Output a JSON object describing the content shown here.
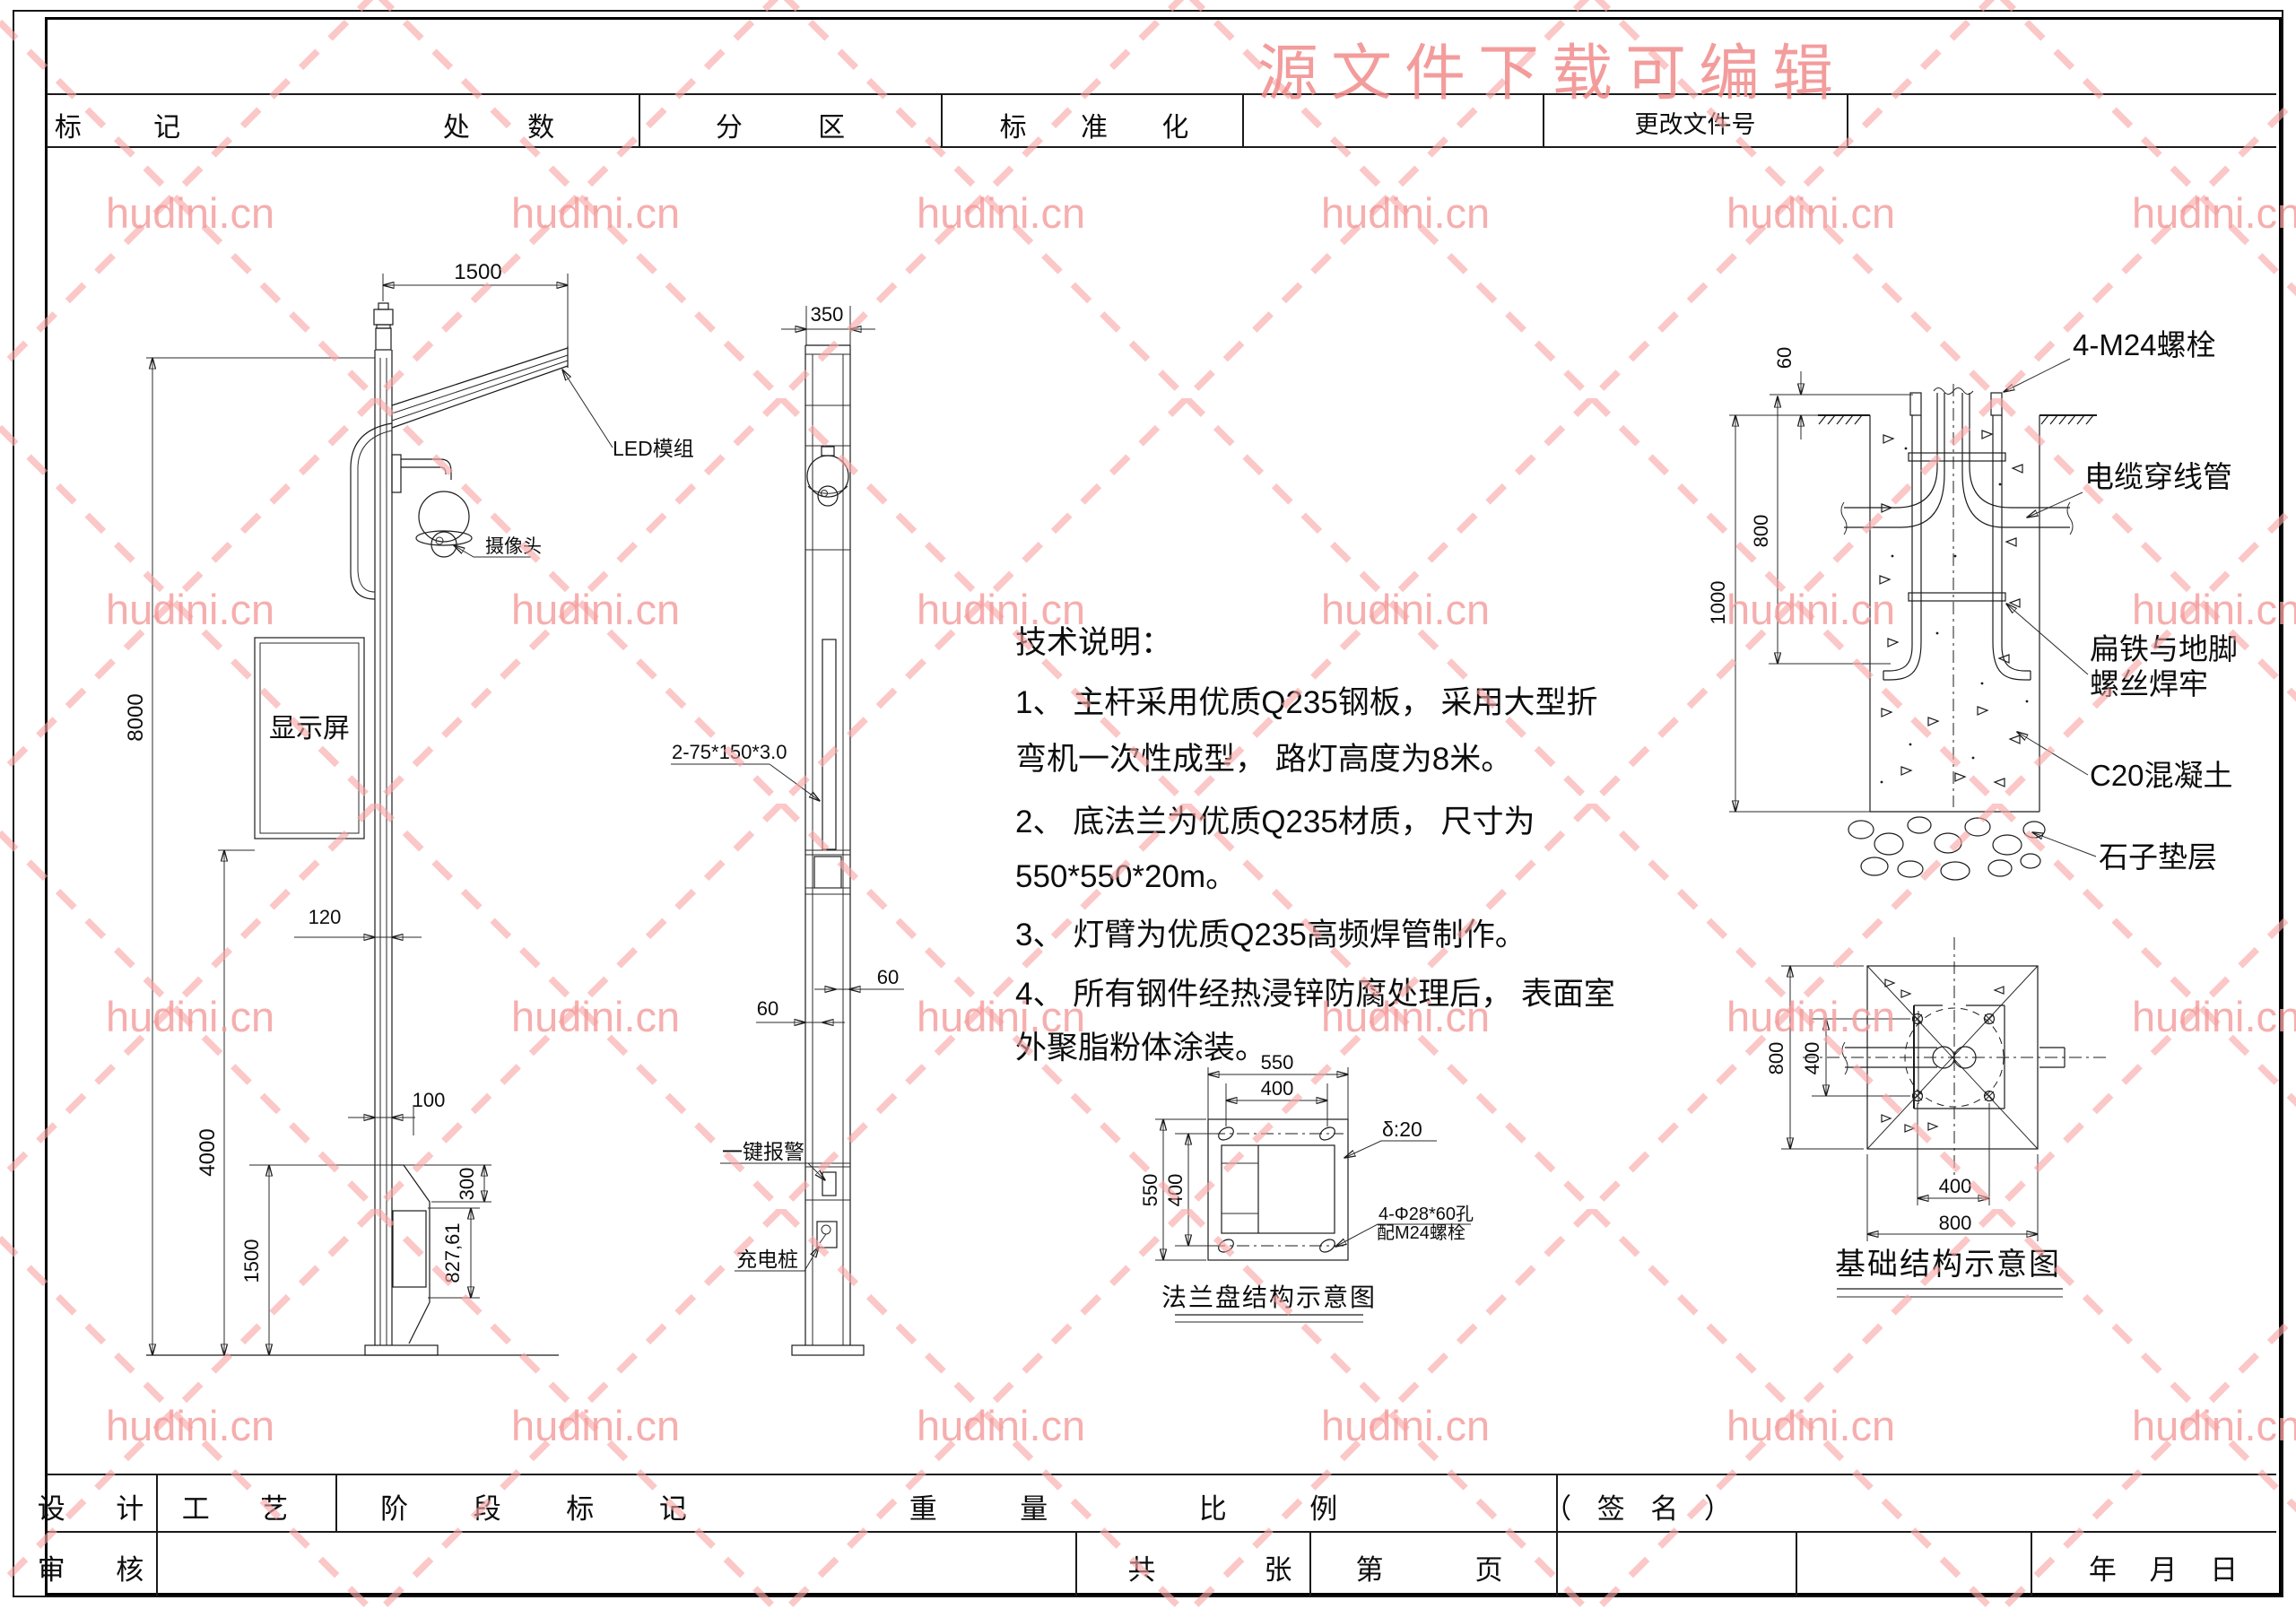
{
  "watermark": {
    "tile_text": "hudini.cn",
    "banner": "源文件下载可编辑",
    "tile_color": "#f49b9b",
    "banner_color": "#f28b8b"
  },
  "top_bar": {
    "mark": "标 记",
    "count": "处 数",
    "zone": "分 区",
    "standardization": "标 准 化",
    "change_doc_no": "更改文件号"
  },
  "left_view": {
    "dims": {
      "arm_length": "1500",
      "pole_height": "8000",
      "screen_height": "4000",
      "pole_width": "120",
      "offset": "100",
      "cabinet_top": "300",
      "cabinet_opening": "827,61",
      "cabinet_height": "1500"
    },
    "labels": {
      "led_module": "LED模组",
      "camera": "摄像头",
      "display_screen": "显示屏"
    }
  },
  "front_view": {
    "dims": {
      "top_width": "350",
      "gap_upper": "60",
      "gap_lower": "60"
    },
    "labels": {
      "plate_spec": "2-75*150*3.0",
      "alarm": "一键报警",
      "charger": "充电桩"
    }
  },
  "notes": {
    "title": "技术说明：",
    "lines": [
      "1、 主杆采用优质Q235钢板， 采用大型折",
      "弯机一次性成型， 路灯高度为8米。",
      "2、 底法兰为优质Q235材质， 尺寸为",
      "550*550*20m。",
      "3、 灯臂为优质Q235高频焊管制作。",
      "4、 所有钢件经热浸锌防腐处理后， 表面室",
      "外聚脂粉体涂装。"
    ]
  },
  "flange": {
    "dims": {
      "top_outer": "550",
      "top_holes": "400",
      "left_outer": "550",
      "left_holes": "400"
    },
    "labels": {
      "thickness": "δ:20",
      "holes_line1": "4-Φ28*60孔",
      "holes_line2": "配M24螺栓"
    },
    "caption": "法兰盘结构示意图"
  },
  "foundation_section": {
    "dims": {
      "bolt_exposed": "60",
      "bolt_depth": "800",
      "block_depth": "1000"
    },
    "labels": {
      "bolts": "4-M24螺栓",
      "conduit": "电缆穿线管",
      "flat_iron_line1": "扁铁与地脚",
      "flat_iron_line2": "螺丝焊牢",
      "concrete": "C20混凝土",
      "gravel": "石子垫层"
    }
  },
  "foundation_plan": {
    "dims": {
      "side_left": "800",
      "bolt_spacing_left": "400",
      "bolt_spacing_bottom": "400",
      "side_bottom": "800"
    },
    "caption": "基础结构示意图"
  },
  "bottom_bar": {
    "row1": {
      "design": "设 计",
      "process": "工 艺",
      "stage_mark": "阶 段 标 记",
      "weight": "重 量",
      "scale": "比 例",
      "signature": "（ 签 名 ）"
    },
    "row2": {
      "review": "审 核",
      "total": "共",
      "sheets": "张",
      "no": "第",
      "page": "页",
      "date": "年  月  日"
    }
  }
}
